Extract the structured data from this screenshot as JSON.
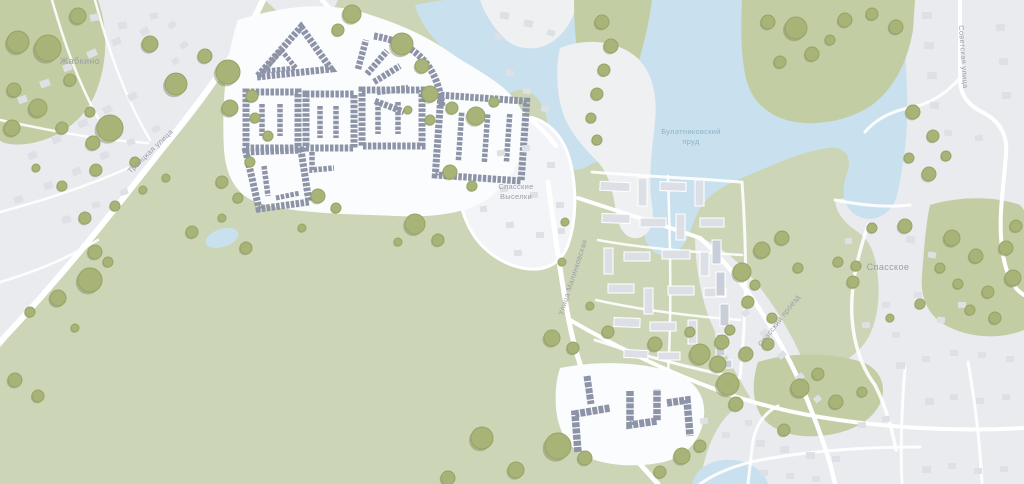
{
  "map": {
    "settlements": {
      "zhabkino": "Жабкино",
      "spasskie_vyselki_line1": "Спасские",
      "spasskie_vyselki_line2": "Выселки",
      "spasskoye": "Спасское"
    },
    "water": {
      "pond_label_line1": "Булатниковский",
      "pond_label_line2": "пруд"
    },
    "streets": {
      "troitskaya": "Троицкая улица",
      "sovetskaya": "Советская улица",
      "malinkovskaya": "Улица Малинковская",
      "spassky_proezd": "Спасский проезд"
    },
    "colors": {
      "land_green": "#ccd5b5",
      "forest_green": "#c3cda4",
      "settlement_gray": "#e9ebef",
      "pale_land": "#eef0f2",
      "oval_fill": "#f3f4f7",
      "pad_white": "#fbfcfd",
      "water_blue": "#c9e1ee",
      "road_white": "#ffffff",
      "tree_fill": "#a8b377",
      "tree_stroke": "#97a465",
      "tree_shadow": "#78865a",
      "building_highlight": "#8e94a8",
      "building_gray": "#dce0e6",
      "building_gray_dark": "#c9cfd9",
      "house_gray": "#dde0e5",
      "label_gray": "#99a0a7",
      "label_blue": "#8ab3cc"
    }
  }
}
